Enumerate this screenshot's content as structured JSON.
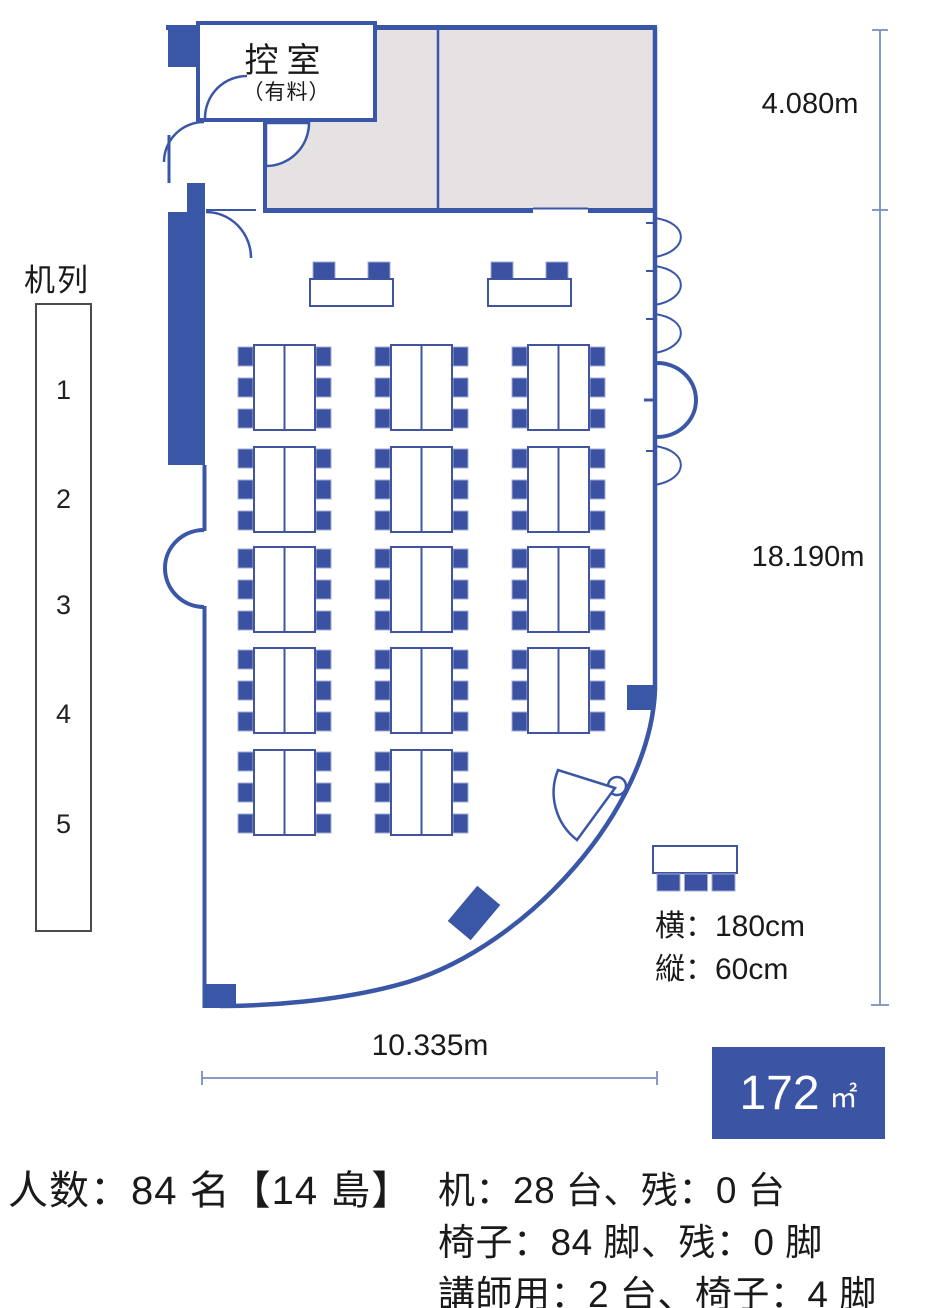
{
  "floor_plan": {
    "anteroom": {
      "label": "控室",
      "note": "（有料）"
    },
    "desk_rows": {
      "title": "机列",
      "numbers": [
        "1",
        "2",
        "3",
        "4",
        "5"
      ]
    },
    "dimensions": {
      "upper_height": "4.080m",
      "lower_height": "18.190m",
      "width": "10.335m"
    },
    "desk_size": {
      "width_label": "横：180cm",
      "depth_label": "縦：60cm"
    },
    "area": {
      "value": "172",
      "unit": "㎡"
    },
    "layout_counts": {
      "islands": 14,
      "island_rows": 5,
      "island_columns": 3,
      "chairs_per_island": 6,
      "lecturer_desks": 2
    },
    "colors": {
      "wall": "#3a57a7",
      "furniture": "#3b52a2",
      "room_fill": "#e6e2e4",
      "dimension_line": "#7b8cc2",
      "area_box": "#3b55a4"
    }
  },
  "summary": {
    "capacity": "人数：84 名【14 島】",
    "desks": "机：28 台、残：0 台",
    "chairs": "椅子：84 脚、残：0 脚",
    "lecturer": "講師用：2 台、椅子：4 脚"
  }
}
